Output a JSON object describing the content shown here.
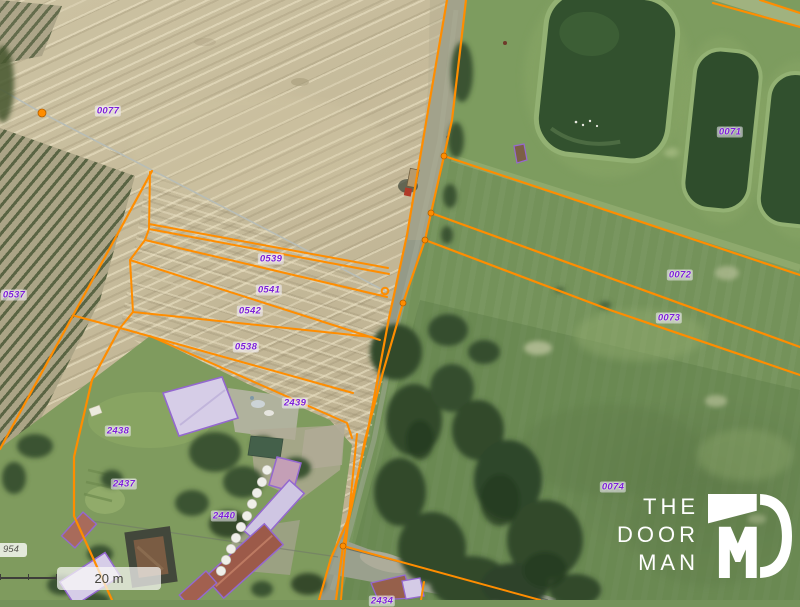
{
  "app": {
    "type": "aerial-cadastral-map-viewer"
  },
  "branding": {
    "logo_lines": [
      "THE",
      "DOOR",
      "MAN"
    ],
    "logo_mark": "DM-monogram"
  },
  "scale_bar": {
    "label": "20 m"
  },
  "road_label": {
    "text": "954",
    "x": -9,
    "y": 543
  },
  "parcel_labels": [
    {
      "id": "0077",
      "x": 108,
      "y": 111
    },
    {
      "id": "0537",
      "x": 14,
      "y": 295
    },
    {
      "id": "0539",
      "x": 271,
      "y": 259
    },
    {
      "id": "0541",
      "x": 269,
      "y": 290
    },
    {
      "id": "0542",
      "x": 250,
      "y": 311
    },
    {
      "id": "0538",
      "x": 246,
      "y": 347
    },
    {
      "id": "2439",
      "x": 295,
      "y": 403
    },
    {
      "id": "2438",
      "x": 118,
      "y": 431
    },
    {
      "id": "2437",
      "x": 124,
      "y": 484
    },
    {
      "id": "2440",
      "x": 224,
      "y": 516
    },
    {
      "id": "0071",
      "x": 730,
      "y": 132
    },
    {
      "id": "0072",
      "x": 680,
      "y": 275
    },
    {
      "id": "0073",
      "x": 669,
      "y": 318
    },
    {
      "id": "0074",
      "x": 613,
      "y": 487
    },
    {
      "id": "2434",
      "x": 382,
      "y": 601
    }
  ],
  "markers": {
    "vertex_color": "#ff8d00",
    "vertices": [
      {
        "x": 42,
        "y": 113,
        "r": 4
      },
      {
        "x": 444,
        "y": 156,
        "r": 3
      },
      {
        "x": 431,
        "y": 213,
        "r": 3
      },
      {
        "x": 425,
        "y": 240,
        "r": 3
      },
      {
        "x": 403,
        "y": 303,
        "r": 3
      },
      {
        "x": 343,
        "y": 546,
        "r": 3
      }
    ],
    "ring_marker": {
      "x": 385,
      "y": 291,
      "r": 3.3
    }
  },
  "colors": {
    "boundary_orange": "#ff8d00",
    "parcel_label_purple": "#7d1fd8",
    "building_fill": "#d6cde7",
    "building_outline": "#9468cf",
    "unselected_boundary_gray": "#b8bdb6"
  }
}
